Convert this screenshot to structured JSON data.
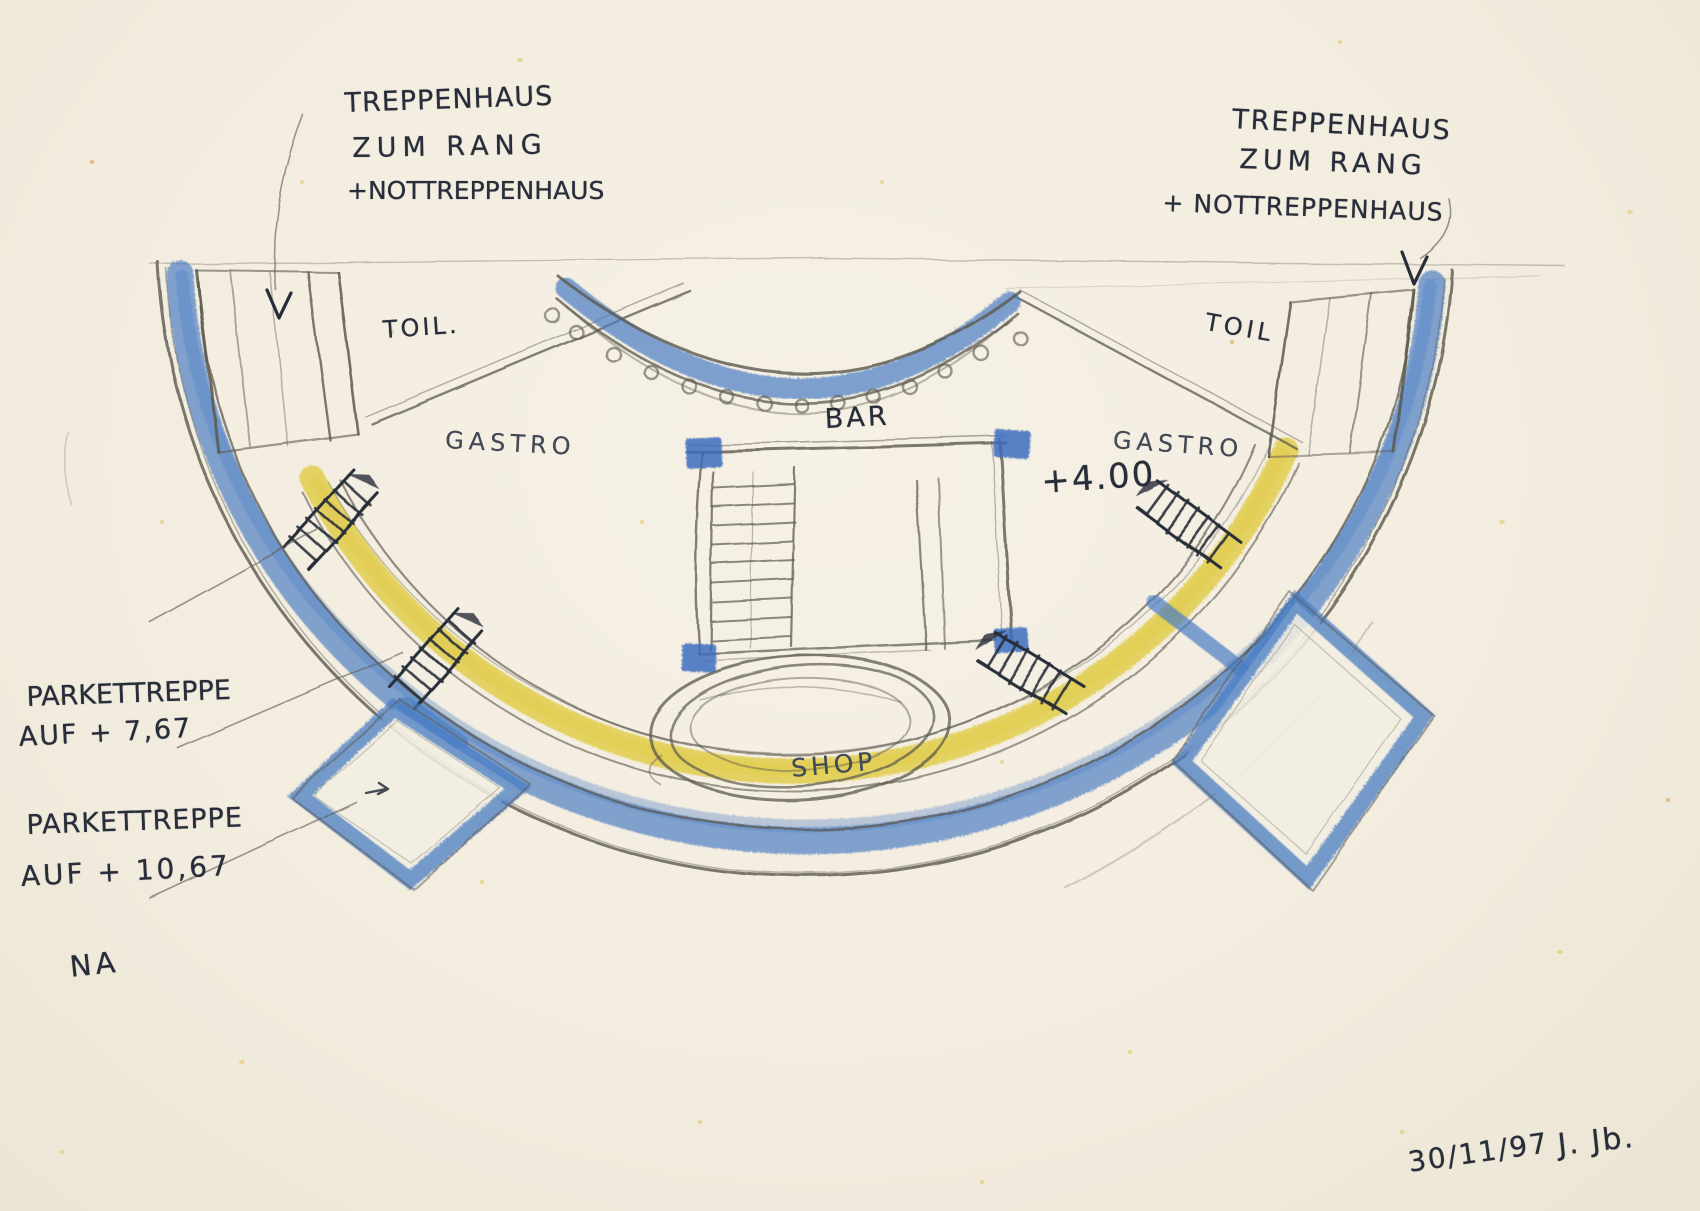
{
  "colors": {
    "paper": "#f3eee1",
    "graphite": "#5c584e",
    "ink": "#272d39",
    "pencil_blue": "#4a7dc3",
    "pencil_blue_dark": "#3465b8",
    "pencil_yellow": "#e0cb45"
  },
  "annotations": {
    "stair_note_left": {
      "line1": "TREPPENHAUS",
      "line2": "ZUM RANG",
      "line3": "+NOTTREPPENHAUS"
    },
    "stair_note_right": {
      "line1": "TREPPENHAUS",
      "line2": "ZUM RANG",
      "line3": "+ NOTTREPPENHAUS"
    },
    "parkett_note_upper": {
      "line1": "PARKETTREPPE",
      "line2": "AUF + 7,67"
    },
    "parkett_note_lower": {
      "line1": "PARKETTREPPE",
      "line2": "AUF + 10,67"
    },
    "na_label": "NA",
    "level_label": "+4.00",
    "date": "30/11/97",
    "signature": "J. Jb."
  },
  "rooms": {
    "toilet_left": "TOIL.",
    "toilet_right": "TOIL",
    "gastro_left": "GASTRO",
    "gastro_right": "GASTRO",
    "bar": "BAR",
    "shop": "SHOP"
  }
}
